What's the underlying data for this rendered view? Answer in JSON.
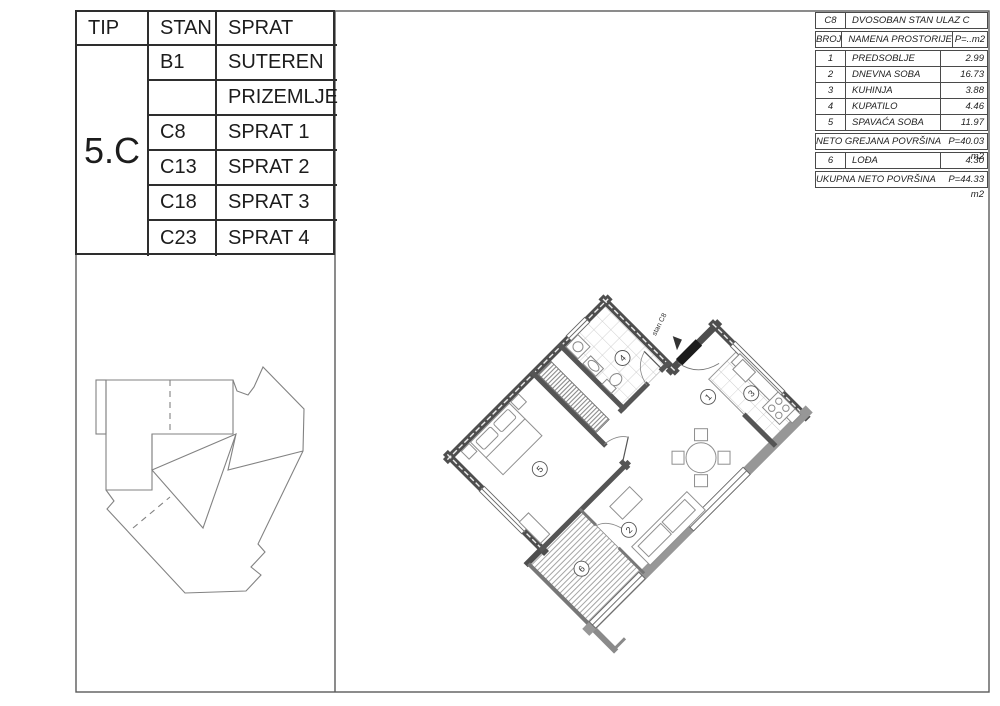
{
  "left_table": {
    "headers": [
      "TIP",
      "STAN",
      "SPRAT"
    ],
    "tip_value": "5.C",
    "rows": [
      {
        "stan": "B1",
        "sprat": "SUTEREN"
      },
      {
        "stan": "",
        "sprat": "PRIZEMLJE"
      },
      {
        "stan": "C8",
        "sprat": "SPRAT 1"
      },
      {
        "stan": "C13",
        "sprat": "SPRAT 2"
      },
      {
        "stan": "C18",
        "sprat": "SPRAT 3"
      },
      {
        "stan": "C23",
        "sprat": "SPRAT 4"
      }
    ]
  },
  "right_table": {
    "code": "C8",
    "title": "DVOSOBAN STAN ULAZ C",
    "col_headers": [
      "BROJ",
      "NAMENA PROSTORIJE",
      "P=..m2"
    ],
    "rooms": [
      [
        "1",
        "PREDSOBLJE",
        "2.99"
      ],
      [
        "2",
        "DNEVNA SOBA",
        "16.73"
      ],
      [
        "3",
        "KUHINJA",
        "3.88"
      ],
      [
        "4",
        "KUPATILO",
        "4.46"
      ],
      [
        "5",
        "SPAVAĆA SOBA",
        "11.97"
      ]
    ],
    "neto_label": "NETO GREJANA POVRŠINA",
    "neto_value": "P=40.03 m2",
    "loggia_row": [
      "6",
      "LOĐA",
      "4.30"
    ],
    "total_label": "UKUPNA NETO POVRŠINA",
    "total_value": "P=44.33 m2"
  },
  "plan": {
    "entrance_label": "stan C8",
    "room_numbers": [
      "1",
      "2",
      "3",
      "4",
      "5",
      "6"
    ]
  }
}
